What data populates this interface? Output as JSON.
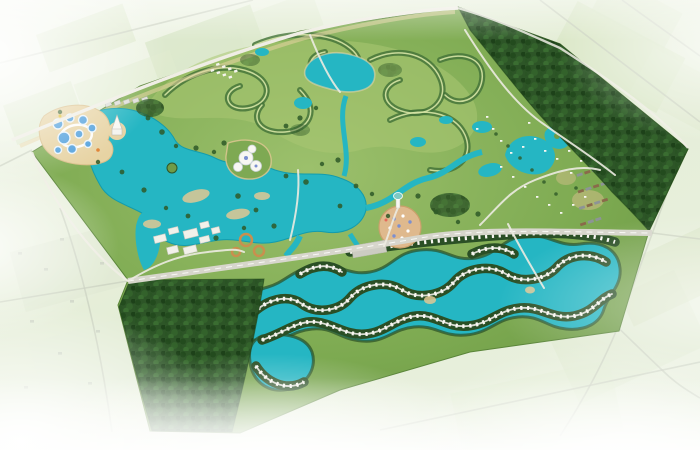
{
  "scene": {
    "type": "aerial-masterplan-render",
    "regions": [
      {
        "id": "surrounding-farmland",
        "label": "Faded farmland and village surroundings"
      },
      {
        "id": "masterplan-site",
        "label": "Resort masterplan site"
      },
      {
        "id": "golf-course",
        "label": "Golf course with winding tree-lined fairways"
      },
      {
        "id": "northeast-forest-belt",
        "label": "Dense forest belt along north-east boundary"
      },
      {
        "id": "southwest-forest-block",
        "label": "Dense forest block at south-west"
      },
      {
        "id": "water-park",
        "label": "Water park with round pools and lazy river"
      },
      {
        "id": "castle-island",
        "label": "Castle island in west lake"
      },
      {
        "id": "central-lake",
        "label": "Central lake system with sandy beaches"
      },
      {
        "id": "dome-pavilion",
        "label": "White dome pavilion complex on peninsula"
      },
      {
        "id": "event-plaza",
        "label": "Circular tan event plaza with canopies"
      },
      {
        "id": "villa-lagoon",
        "label": "Serpentine turquoise villa lagoon with waterfront villas"
      },
      {
        "id": "resort-village",
        "label": "Resort village cluster in forest clearing"
      },
      {
        "id": "hotel-cluster",
        "label": "Hotel and convention buildings"
      },
      {
        "id": "row-housing",
        "label": "Townhouse rows"
      },
      {
        "id": "main-boulevard",
        "label": "Main boulevard through the site"
      },
      {
        "id": "boundary-road",
        "label": "North-west boundary road"
      }
    ]
  },
  "palette": {
    "lake": "#25b6c3",
    "lake_deep": "#139cad",
    "site_green": "#7ca94f",
    "golf_green": "#a9c672",
    "forest_dark": "#2d5527",
    "tree_line": "#2a4f25",
    "sand": "#e7d3a3",
    "beach": "#e2c894",
    "road_light": "#efede4",
    "road_grey": "#d7d6cc",
    "pool_blue": "#4f9fdc",
    "plaza_tan": "#dfb98d",
    "villa_white": "#f8f7f2",
    "roof_grey": "#8d9496",
    "roof_brown": "#8a6a4a",
    "farmland": "#e8efdd",
    "farm_field": "#cddfb9",
    "fog": "#ffffff",
    "ochre": "#c98f4e"
  }
}
